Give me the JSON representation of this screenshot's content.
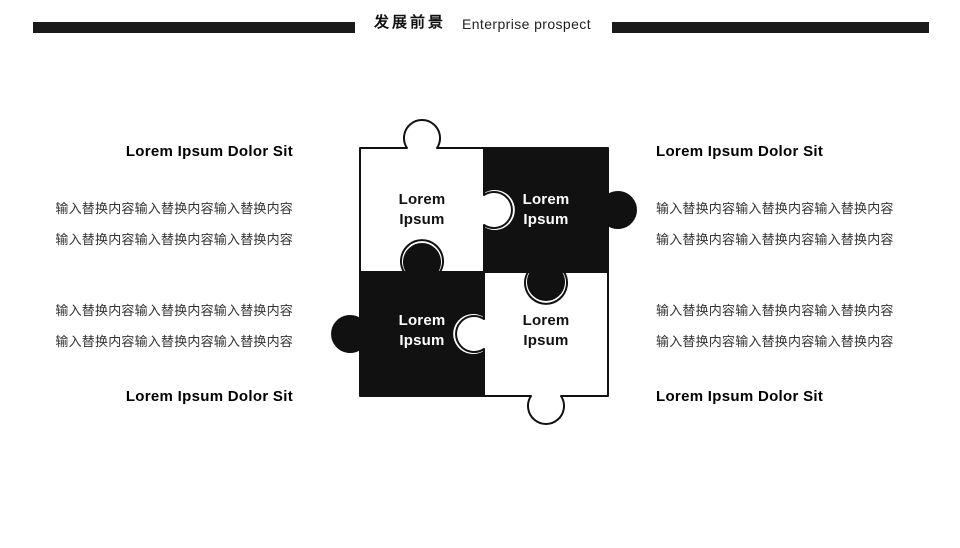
{
  "header": {
    "title_zh": "发展前景",
    "title_en": "Enterprise prospect",
    "bar_color": "#1a1a1a"
  },
  "puzzle": {
    "colors": {
      "white": "#ffffff",
      "black": "#111111",
      "outline": "#111111"
    },
    "pieces": [
      {
        "position": "top-left",
        "fill": "white",
        "label_line1": "Lorem",
        "label_line2": "Ipsum"
      },
      {
        "position": "top-right",
        "fill": "black",
        "label_line1": "Lorem",
        "label_line2": "Ipsum"
      },
      {
        "position": "bottom-left",
        "fill": "black",
        "label_line1": "Lorem",
        "label_line2": "Ipsum"
      },
      {
        "position": "bottom-right",
        "fill": "white",
        "label_line1": "Lorem",
        "label_line2": "Ipsum"
      }
    ]
  },
  "sections": {
    "top_left": {
      "heading": "Lorem Ipsum Dolor Sit",
      "lines": [
        "输入替换内容输入替换内容输入替换内容",
        "输入替换内容输入替换内容输入替换内容"
      ]
    },
    "top_right": {
      "heading": "Lorem Ipsum Dolor Sit",
      "lines": [
        "输入替换内容输入替换内容输入替换内容",
        "输入替换内容输入替换内容输入替换内容"
      ]
    },
    "bottom_left": {
      "heading": "Lorem Ipsum Dolor Sit",
      "lines": [
        "输入替换内容输入替换内容输入替换内容",
        "输入替换内容输入替换内容输入替换内容"
      ]
    },
    "bottom_right": {
      "heading": "Lorem Ipsum Dolor Sit",
      "lines": [
        "输入替换内容输入替换内容输入替换内容",
        "输入替换内容输入替换内容输入替换内容"
      ]
    }
  }
}
